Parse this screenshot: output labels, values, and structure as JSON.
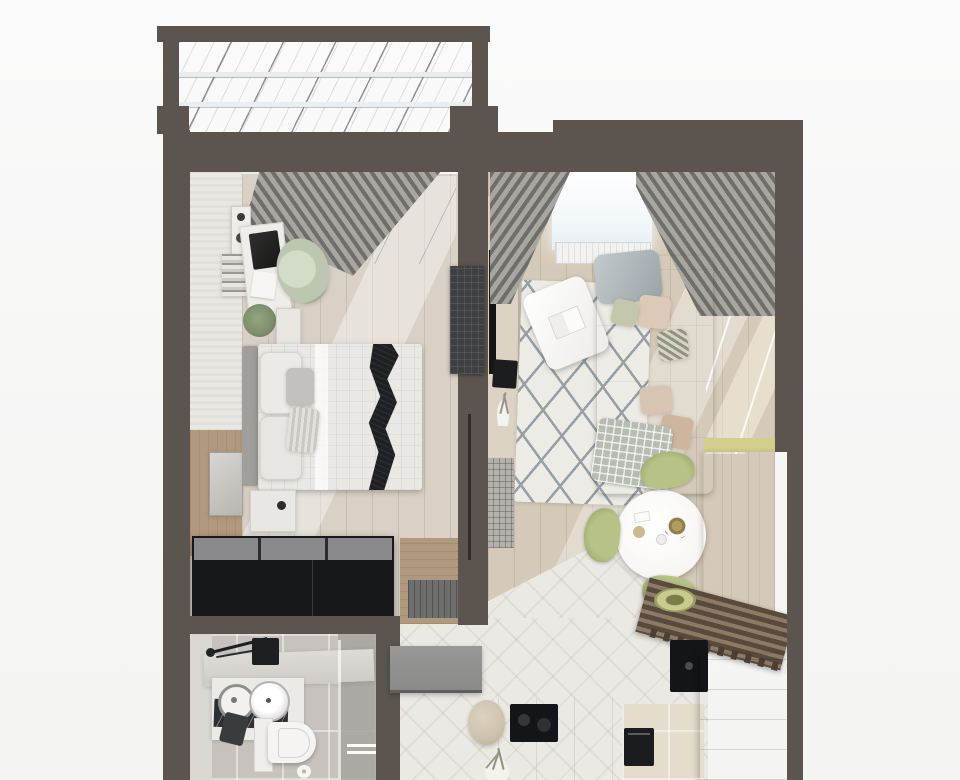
{
  "meta": {
    "kind": "photorealistic 3d floor plan, top-down view",
    "scene": "one-bedroom apartment with glazed balcony, bedroom, living-dining room, bathroom, hall and kitchen (image cropped at bottom)"
  },
  "colors": {
    "bg": "#f7f7f6",
    "wall": "#5b544f",
    "glass": "#f4f9fb",
    "mullion": "#5f646b",
    "window_light": "#eef6f9",
    "bedroom_floor": "#d9d1c6",
    "living_floor": "#d5cab9",
    "hall_tile": "#ebe9e4",
    "kitchen_tile": "#e4ddce",
    "bath_floor": "#c7c2bd",
    "bath_wallband": "#dad7d3",
    "green_wall": "#a1a164",
    "sofa": "#c7a891",
    "sofa_light": "#d5bba6",
    "rug": "#edebe5",
    "rug_lattice": "#969ea6",
    "curtain": "#a8a6a1",
    "curtain_stripe": "#6f6e6a",
    "bed_linen": "#e9e8e4",
    "pillow_gray": "#c2c1bd",
    "headboard": "#a09f9b",
    "throw_black": "#1f2024",
    "wardrobe_black": "#17181b",
    "wardrobe_top": "#8a8a8c",
    "wood_warm": "#c8b093",
    "wood_light": "#d8c6ab",
    "appliance_black": "#141518",
    "chair_green": "#b7c286",
    "chair_green_dark": "#8e9a5e",
    "table_white": "#f7f6f3",
    "white": "#f3f2ef",
    "tan_panel": "#b1997e",
    "sage_chair": "#bcc6b0",
    "plant_green": "#7c8e6c",
    "door_gray": "#909090",
    "grille_gray": "#b3b1ac",
    "plaid": "#b6bdb0",
    "drape_gray": "#b3babe",
    "pouf": "#cec2ad",
    "marble_black": "#2e2f33"
  },
  "rooms": {
    "balcony": {
      "name": "glazed balcony",
      "items": [
        "glass-roof",
        "roof-beams"
      ]
    },
    "bedroom": {
      "name": "bedroom",
      "items": [
        "striped-curtain",
        "balcony-window",
        "speaker",
        "book-stack",
        "desk",
        "laptop",
        "sage-armchair",
        "plant",
        "side-table",
        "double-bed",
        "headboard",
        "pillows",
        "black-wave-throw",
        "nightstand",
        "black-wardrobe",
        "door-mat",
        "wall-tv-grid",
        "mirror",
        "tan-wall-panel"
      ]
    },
    "living_room": {
      "name": "living-dining room",
      "items": [
        "left-curtain",
        "right-curtain",
        "window",
        "radiator",
        "media-console",
        "tv",
        "decor-sphere",
        "twig-vase",
        "trellis-rug",
        "coffee-table",
        "book",
        "beige-sofa",
        "cushions",
        "gray-drape",
        "plaid-throw",
        "green-accent-wall",
        "floor-grille",
        "round-dining-table",
        "dried-flowers",
        "green-chairs",
        "tall-white-cabinet",
        "yellow-accent-strip",
        "slat-bench",
        "green-bowl",
        "black-wall-panel",
        "drawer-unit"
      ]
    },
    "bathroom": {
      "name": "bathroom",
      "items": [
        "vanity-counter",
        "black-shower-set",
        "black-box",
        "white-cabinet",
        "round-washer-door",
        "round-sink",
        "black-marble-top",
        "dark-towel",
        "toilet",
        "toilet-paper",
        "floor-drain",
        "glass-screen"
      ]
    },
    "hall": {
      "name": "hall",
      "items": [
        "open-door-leaf",
        "pouf",
        "vase-with-branches",
        "chevron-marble-floor"
      ]
    },
    "kitchen": {
      "name": "kitchen",
      "items": [
        "wood-counter",
        "cooktop",
        "oven-front",
        "beige-tile-floor"
      ]
    }
  }
}
